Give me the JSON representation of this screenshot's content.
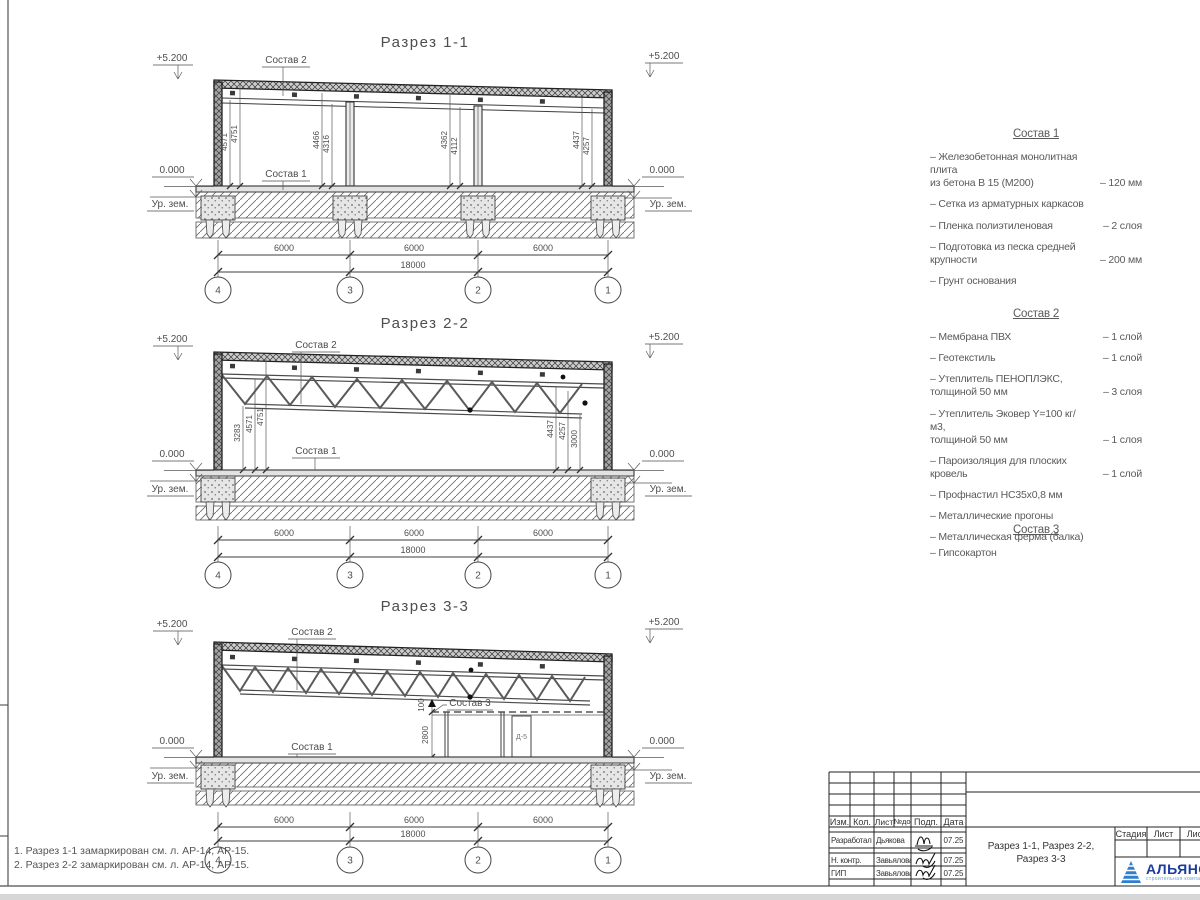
{
  "drawing": {
    "marks": {
      "top": "+5.200",
      "zero": "0.000",
      "ground": "Ур. зем."
    },
    "axes": {
      "labels": [
        "4",
        "3",
        "2",
        "1"
      ],
      "span": "6000",
      "total": "18000"
    },
    "sections": {
      "s1": {
        "title": "Разрез 1-1",
        "vdims": [
          "4571",
          "4751",
          "4466",
          "4316",
          "4362",
          "4112",
          "4437",
          "4257"
        ]
      },
      "s2": {
        "title": "Разрез 2-2",
        "left_vdims": [
          "3283",
          "4571",
          "4751"
        ],
        "right_vdims": [
          "4437",
          "4257",
          "3000"
        ]
      },
      "s3": {
        "title": "Разрез 3-3",
        "vdims": [
          "100",
          "2800"
        ],
        "door_tag": "Д-5"
      }
    }
  },
  "compositions": [
    {
      "title": "Состав 1",
      "items": [
        {
          "name": "– Железобетонная  монолитная плита\nиз бетона В 15 (М200)",
          "value": "– 120 мм"
        },
        {
          "name": "– Сетка из арматурных каркасов",
          "value": ""
        },
        {
          "name": "– Пленка полиэтиленовая",
          "value": "– 2 слоя"
        },
        {
          "name": "– Подготовка из песка средней\nкрупности",
          "value": "– 200 мм"
        },
        {
          "name": "– Грунт основания",
          "value": ""
        }
      ]
    },
    {
      "title": "Состав 2",
      "items": [
        {
          "name": "– Мембрана ПВХ",
          "value": "– 1 слой"
        },
        {
          "name": "– Геотекстиль",
          "value": "– 1 слой"
        },
        {
          "name": "– Утеплитель ПЕНОПЛЭКС,\nтолщиной 50 мм",
          "value": "– 3 слоя"
        },
        {
          "name": "– Утеплитель Эковер Y=100 кг/м3,\nтолщиной 50 мм",
          "value": "– 1 слоя"
        },
        {
          "name": "– Пароизоляция для плоских кровель",
          "value": "– 1 слой"
        },
        {
          "name": "– Профнастил НС35х0,8 мм",
          "value": ""
        },
        {
          "name": "– Металлические прогоны",
          "value": ""
        },
        {
          "name": "– Металлическая ферма (балка)",
          "value": ""
        }
      ]
    },
    {
      "title": "Состав 3",
      "items": [
        {
          "name": "– Гипсокартон",
          "value": ""
        }
      ]
    }
  ],
  "notes": [
    "1. Разрез 1-1 замаркирован см. л. АР-14, АР-15.",
    "2. Разрез 2-2 замаркирован см. л. АР-14, АР-15."
  ],
  "titleblock": {
    "header_cells": [
      "Изм.",
      "Кол.",
      "Лист",
      "№док",
      "Подп.",
      "Дата"
    ],
    "rows": [
      {
        "role": "Разработал",
        "name": "Дьякова",
        "date": "07.25"
      },
      {
        "role": "Н. контр.",
        "name": "Завьялова",
        "date": "07.25"
      },
      {
        "role": "ГИП",
        "name": "Завьялова",
        "date": "07.25"
      }
    ],
    "doc_title_line1": "Разрез 1-1, Разрез 2-2,",
    "doc_title_line2": "Разрез 3-3",
    "right_headers": [
      "Стадия",
      "Лист",
      "Лист"
    ],
    "logo_name": "АЛЬЯНС",
    "logo_sub": "строительная компания"
  }
}
